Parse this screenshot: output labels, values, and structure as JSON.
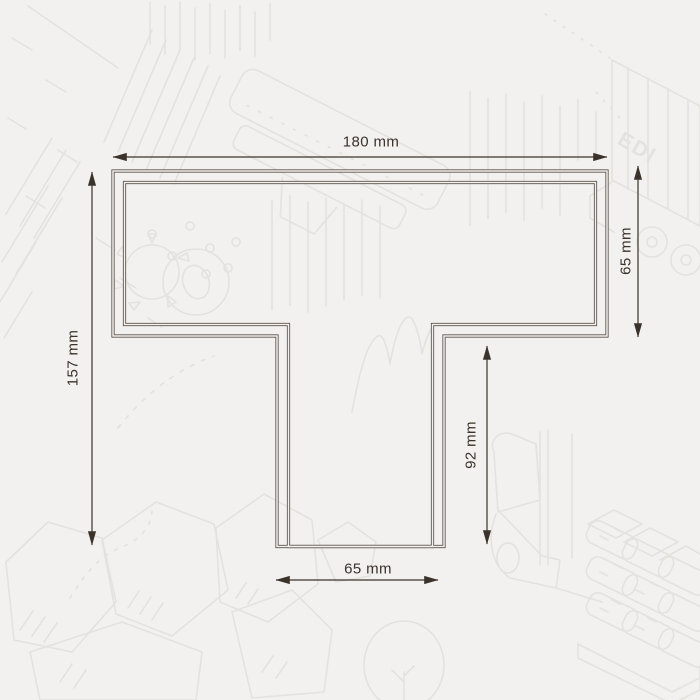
{
  "page": {
    "title": "T-profile technical dimension drawing"
  },
  "colors": {
    "background": "#f2f1ef",
    "outline": "#5b5148",
    "dimension": "#3b332b",
    "doodle": "#e4e2df"
  },
  "dimensions": {
    "top_width": "180 mm",
    "right_flange_height": "65 mm",
    "left_total_height": "157 mm",
    "stem_height": "92 mm",
    "stem_width": "65 mm"
  },
  "background_art": {
    "truck_text": "EDI"
  }
}
